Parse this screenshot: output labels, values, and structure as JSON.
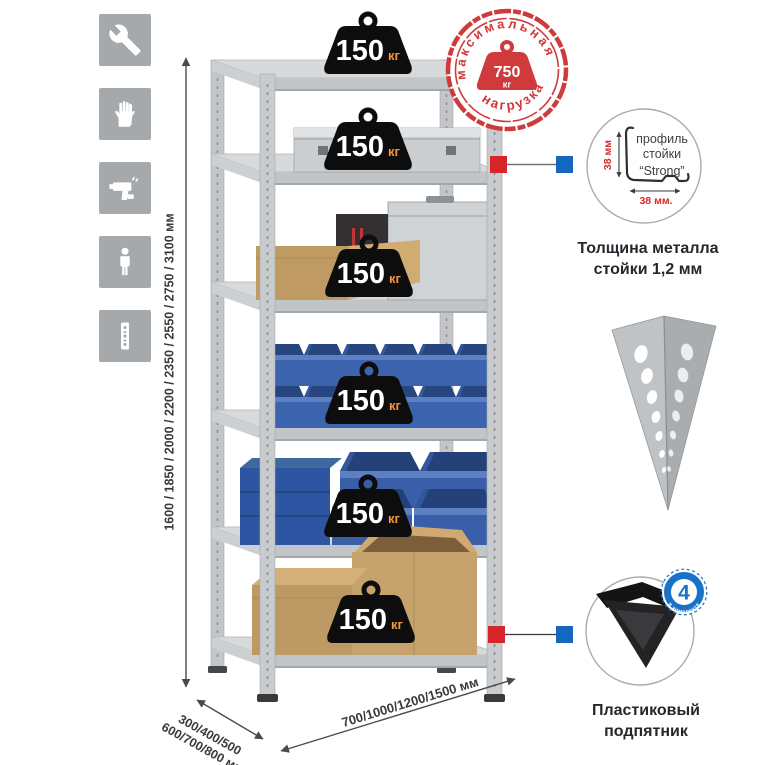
{
  "title": "Metal shelving rack infographic",
  "colors": {
    "accent_red": "#cf3a3c",
    "accent_blue": "#1a72c6",
    "badge_black": "#0d0d0d",
    "badge_unit_orange": "#f5953f",
    "metal_gray": "#c6c9cc",
    "bin_blue": "#3c63ad",
    "cardboard_tan": "#c09a63",
    "icon_tile_gray": "#a6a9ac"
  },
  "left_icons": {
    "items": [
      {
        "name": "wrench"
      },
      {
        "name": "gloves"
      },
      {
        "name": "drill"
      },
      {
        "name": "person"
      },
      {
        "name": "perforated-post"
      }
    ]
  },
  "height_dim": {
    "label": "1600 / 1850 / 2000 / 2200 / 2350 / 2550 / 2750 / 3100 мм"
  },
  "depth_dim": {
    "line1": "300/400/500",
    "line2": "600/700/800 мм"
  },
  "width_dim": {
    "label": "700/1000/1200/1500 мм"
  },
  "badges": {
    "unit": "кг",
    "items": [
      {
        "value": "150"
      },
      {
        "value": "150"
      },
      {
        "value": "150"
      },
      {
        "value": "150"
      },
      {
        "value": "150"
      },
      {
        "value": "150"
      }
    ]
  },
  "stamp": {
    "top": "максимальная",
    "bottom": "нагрузка",
    "value": "750",
    "unit": "кг"
  },
  "profile_callout": {
    "label_line1": "профиль",
    "label_line2": "стойки",
    "label_line3": "“Strong”",
    "dim_vertical": "38 мм",
    "dim_horizontal": "38 мм.",
    "caption_line1": "Толщина металла",
    "caption_line2": "стойки 1,2 мм"
  },
  "foot_callout": {
    "badge_value": "4",
    "badge_label": "в комплекте",
    "caption_line1": "Пластиковый",
    "caption_line2": "подпятник"
  }
}
